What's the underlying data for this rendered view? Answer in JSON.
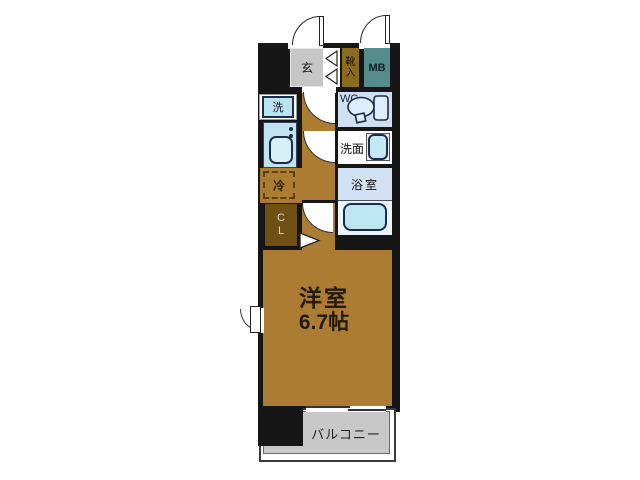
{
  "plan": {
    "entrance": {
      "label": "玄"
    },
    "shoe_cabinet": {
      "label": "靴入",
      "chars": [
        "靴",
        "入"
      ]
    },
    "meter_box": {
      "label": "MB"
    },
    "washer": {
      "label": "洗"
    },
    "wc": {
      "label": "WC"
    },
    "washroom": {
      "label": "洗面"
    },
    "bathroom": {
      "label": "浴室"
    },
    "refrigerator": {
      "label": "冷"
    },
    "closet": {
      "label": "CL",
      "chars": [
        "C",
        "L"
      ]
    },
    "main_room": {
      "name": "洋室",
      "size": "6.7帖"
    },
    "balcony": {
      "label": "バルコニー"
    }
  },
  "colors": {
    "wall": "#161616",
    "wood_floor": "#ac7c32",
    "closet_brown": "#6f5014",
    "shoe_cabinet_olive": "#8a6c1c",
    "meter_box_teal": "#558b8b",
    "entrance_gray": "#c6c6c6",
    "water_room_blue": "#cfe0f2",
    "fixture_cyan": "#bce7f2",
    "balcony_gray": "#c8c8c8"
  }
}
